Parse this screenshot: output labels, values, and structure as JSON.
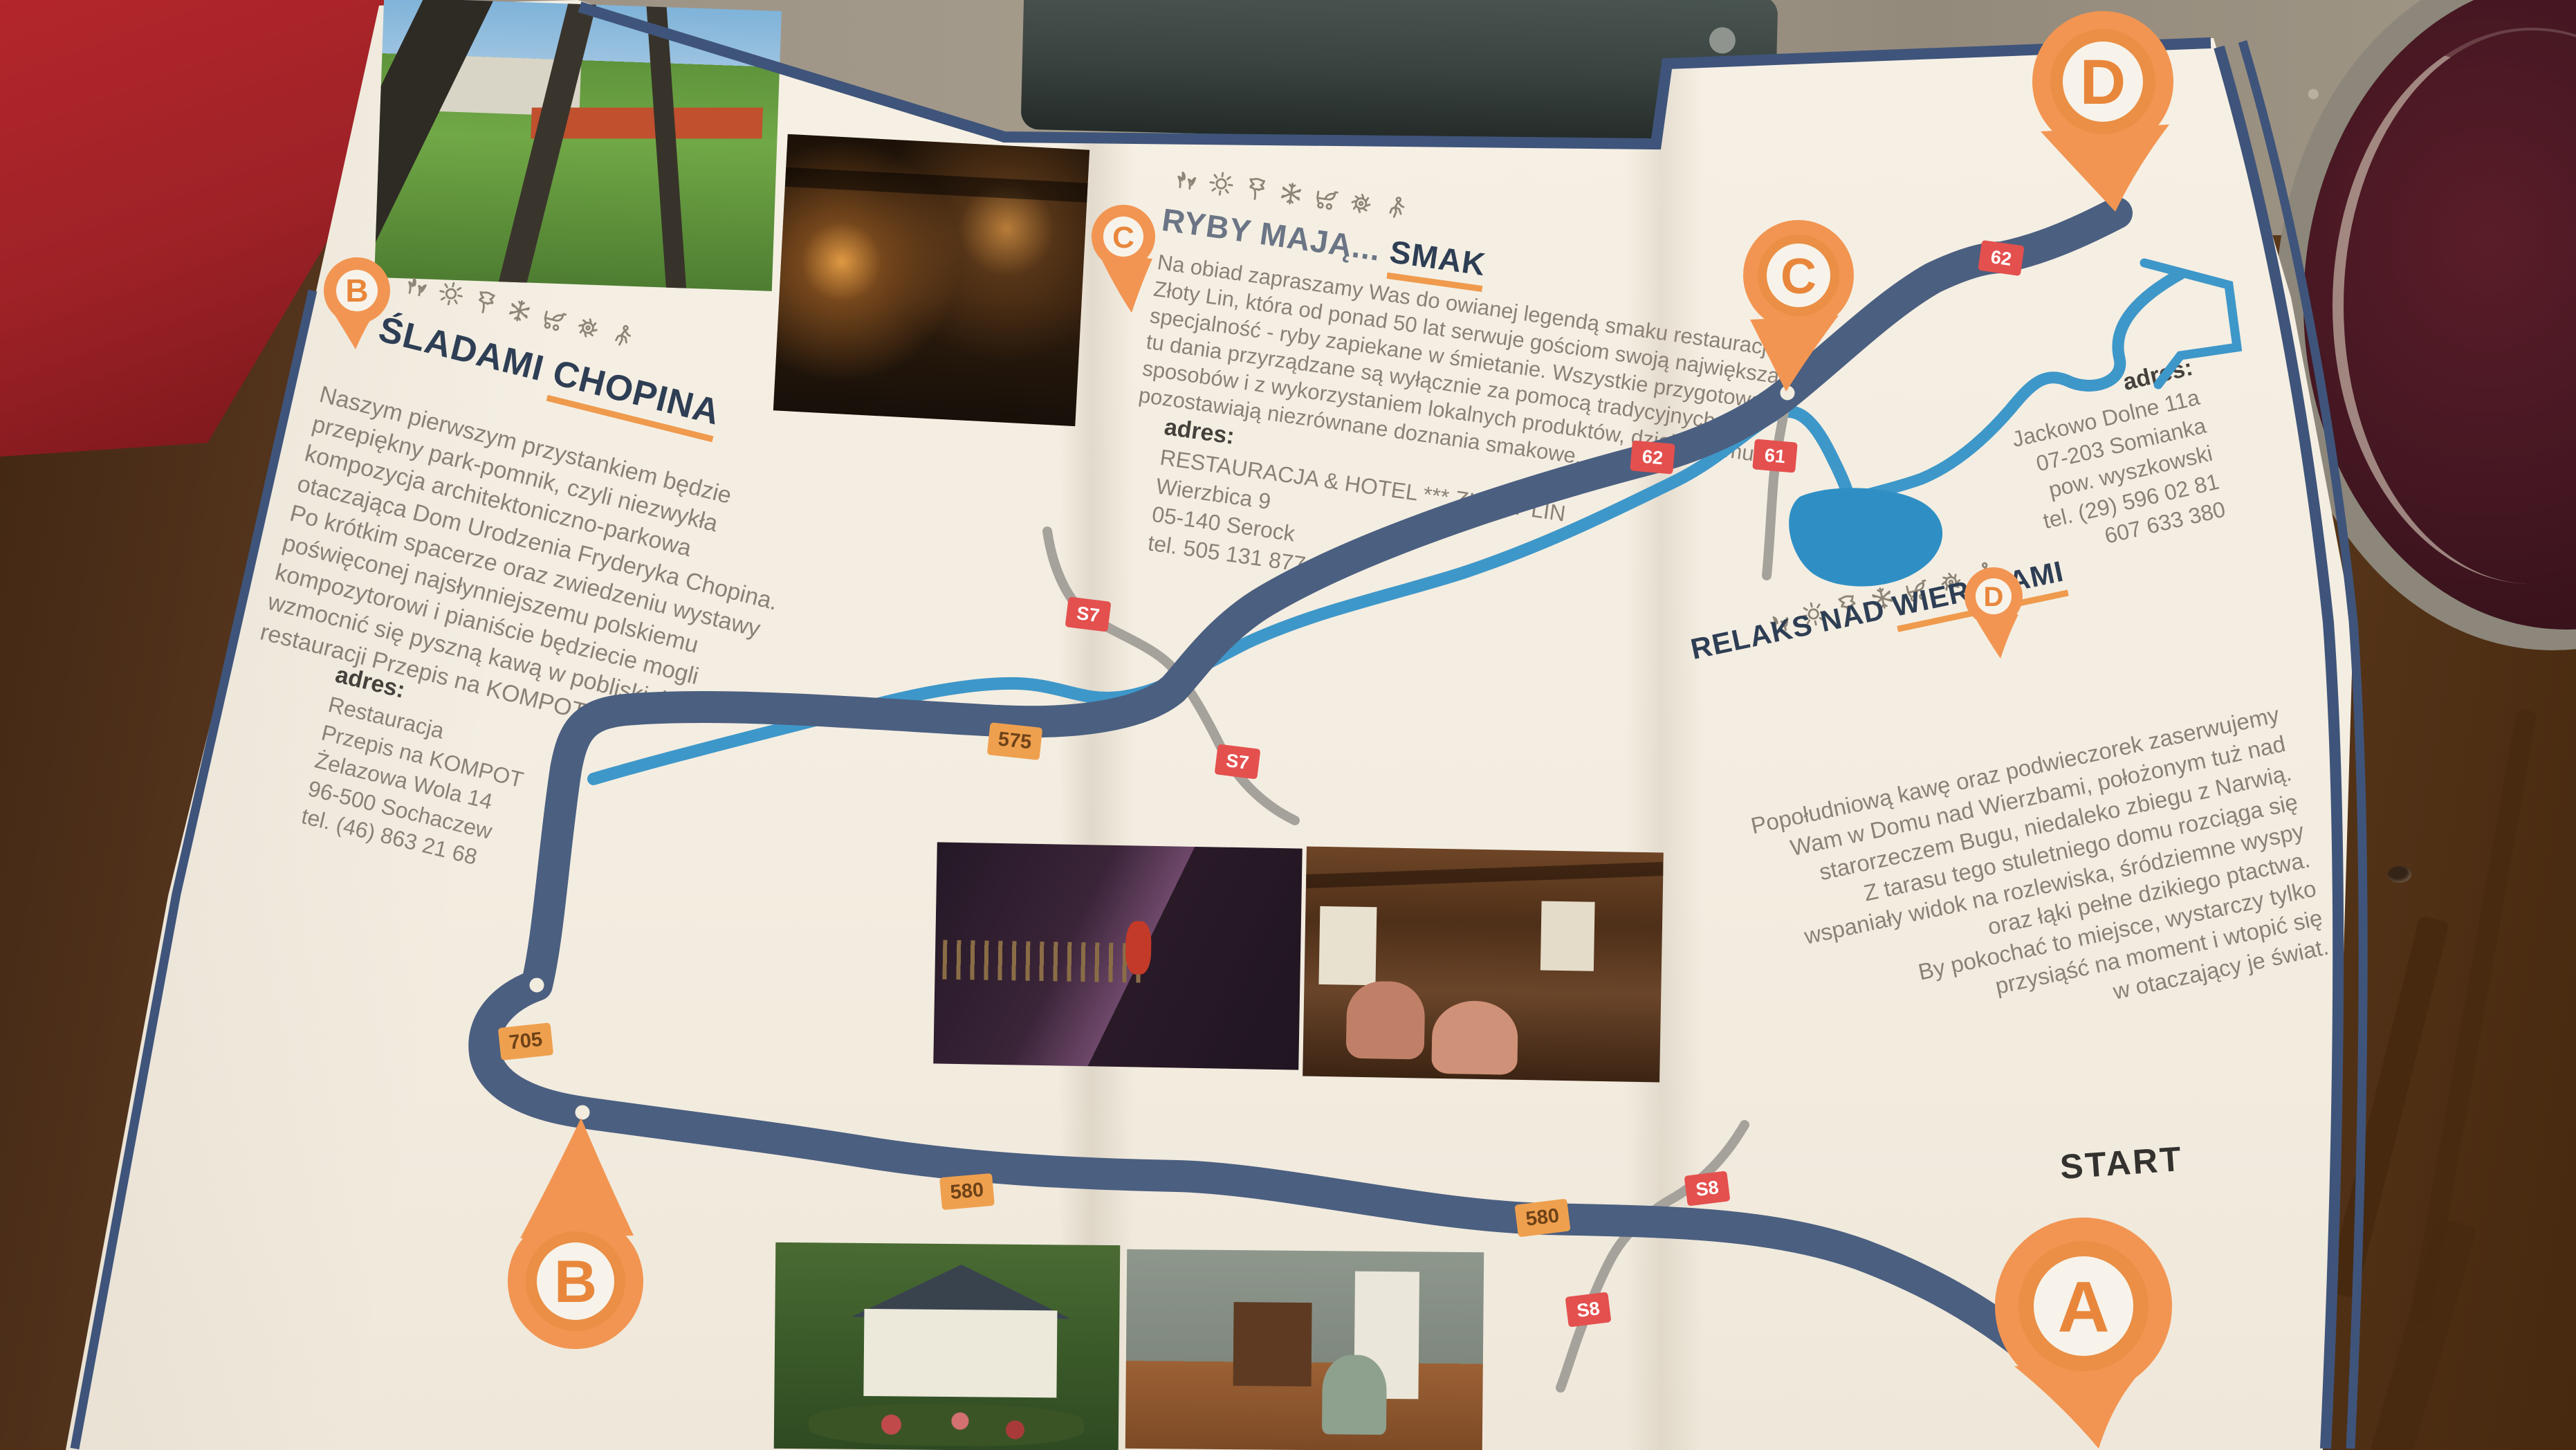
{
  "map": {
    "start_label": "START",
    "pins": [
      {
        "id": "A",
        "letter": "A"
      },
      {
        "id": "B",
        "letter": "B"
      },
      {
        "id": "C",
        "letter": "C"
      },
      {
        "id": "D",
        "letter": "D"
      }
    ],
    "road_badges": [
      {
        "label": "S7",
        "type": "red"
      },
      {
        "label": "S7",
        "type": "red"
      },
      {
        "label": "575",
        "type": "orange"
      },
      {
        "label": "62",
        "type": "red"
      },
      {
        "label": "61",
        "type": "red"
      },
      {
        "label": "62",
        "type": "red"
      },
      {
        "label": "705",
        "type": "orange"
      },
      {
        "label": "580",
        "type": "orange"
      },
      {
        "label": "580",
        "type": "orange"
      },
      {
        "label": "S8",
        "type": "red"
      },
      {
        "label": "S8",
        "type": "red"
      }
    ],
    "colors": {
      "route": "#4b5f80",
      "river": "#3e97c9",
      "lake": "#2f8fc4",
      "road": "#a5a29b",
      "badge_red": "#e4504e",
      "badge_orange": "#efa04e",
      "pin": "#f29552",
      "paper": "#f3ede1",
      "heading": "#2e3e54",
      "underline": "#ef9a4d",
      "body_text": "#8b8076"
    }
  },
  "sections": [
    {
      "id": "chopin",
      "pin_letter": "B",
      "icons": [
        "flower-icon",
        "sun-icon",
        "leaf-icon",
        "snowflake-icon",
        "stroller-icon",
        "sun-wheel-icon",
        "hiker-icon"
      ],
      "title_prefix": "ŚLADAMI ",
      "title_underline": "CHOPINA",
      "body": "Naszym pierwszym przystankiem będzie\nprzepiękny park-pomnik, czyli niezwykła\nkompozycja architektoniczno-parkowa\notaczająca Dom Urodzenia Fryderyka Chopina.\nPo krótkim spacerze oraz zwiedzeniu wystawy\npoświęconej najsłynniejszemu polskiemu\nkompozytorowi i pianiście będziecie mogli\nwzmocnić się pyszną kawą w pobliskiej\nrestauracji Przepis na KOMPOT.",
      "address_label": "adres:",
      "address": "Restauracja\nPrzepis na KOMPOT\nŻelazowa Wola 14\n96-500 Sochaczew\ntel. (46) 863 21 68"
    },
    {
      "id": "zloty-lin",
      "pin_letter": "C",
      "icons": [
        "flower-icon",
        "sun-icon",
        "leaf-icon",
        "snowflake-icon",
        "stroller-icon",
        "sun-wheel-icon",
        "hiker-icon"
      ],
      "title_prefix": "RYBY MAJĄ... ",
      "title_underline": "SMAK",
      "body": "Na obiad zapraszamy Was do owianej legendą smaku restauracji\nZłoty Lin, która od ponad 50 lat serwuje gościom swoją największą\nspecjalność - ryby zapiekane w śmietanie. Wszystkie przygotowane\ntu dania przyrządzane są wyłącznie za pomocą tradycyjnych\nsposobów i z wykorzystaniem lokalnych produktów, dzięki czemu\npozostawiają niezrównane doznania smakowe.",
      "address_label": "adres:",
      "address": "RESTAURACJA & HOTEL *** ZŁOTY LIN\nWierzbica 9\n05-140 Serock\ntel. 505 131 877"
    },
    {
      "id": "wierzbami",
      "pin_letter": "D",
      "icons": [
        "flower-icon",
        "sun-icon",
        "leaf-icon",
        "snowflake-icon",
        "stroller-icon",
        "sun-wheel-icon",
        "hiker-icon"
      ],
      "title_prefix": "RELAKS NAD ",
      "title_underline": "WIERZBAMI",
      "body": "Popołudniową kawę oraz podwieczorek zaserwujemy\nWam w Domu nad Wierzbami, położonym tuż nad\nstarorzeczem Bugu, niedaleko zbiegu z Narwią.\nZ tarasu tego stuletniego domu rozciąga się\nwspaniały widok na rozlewiska, śródziemne wyspy\noraz łąki pełne dzikiego ptactwa.\nBy pokochać to miejsce, wystarczy tylko\nprzysiąść na moment i wtopić się\nw otaczający je świat.",
      "address_label": "adres:",
      "address": "Jackowo Dolne 11a\n07-203 Somianka\npow. wyszkowski\ntel. (29) 596 02 81\n607 633 380"
    }
  ]
}
